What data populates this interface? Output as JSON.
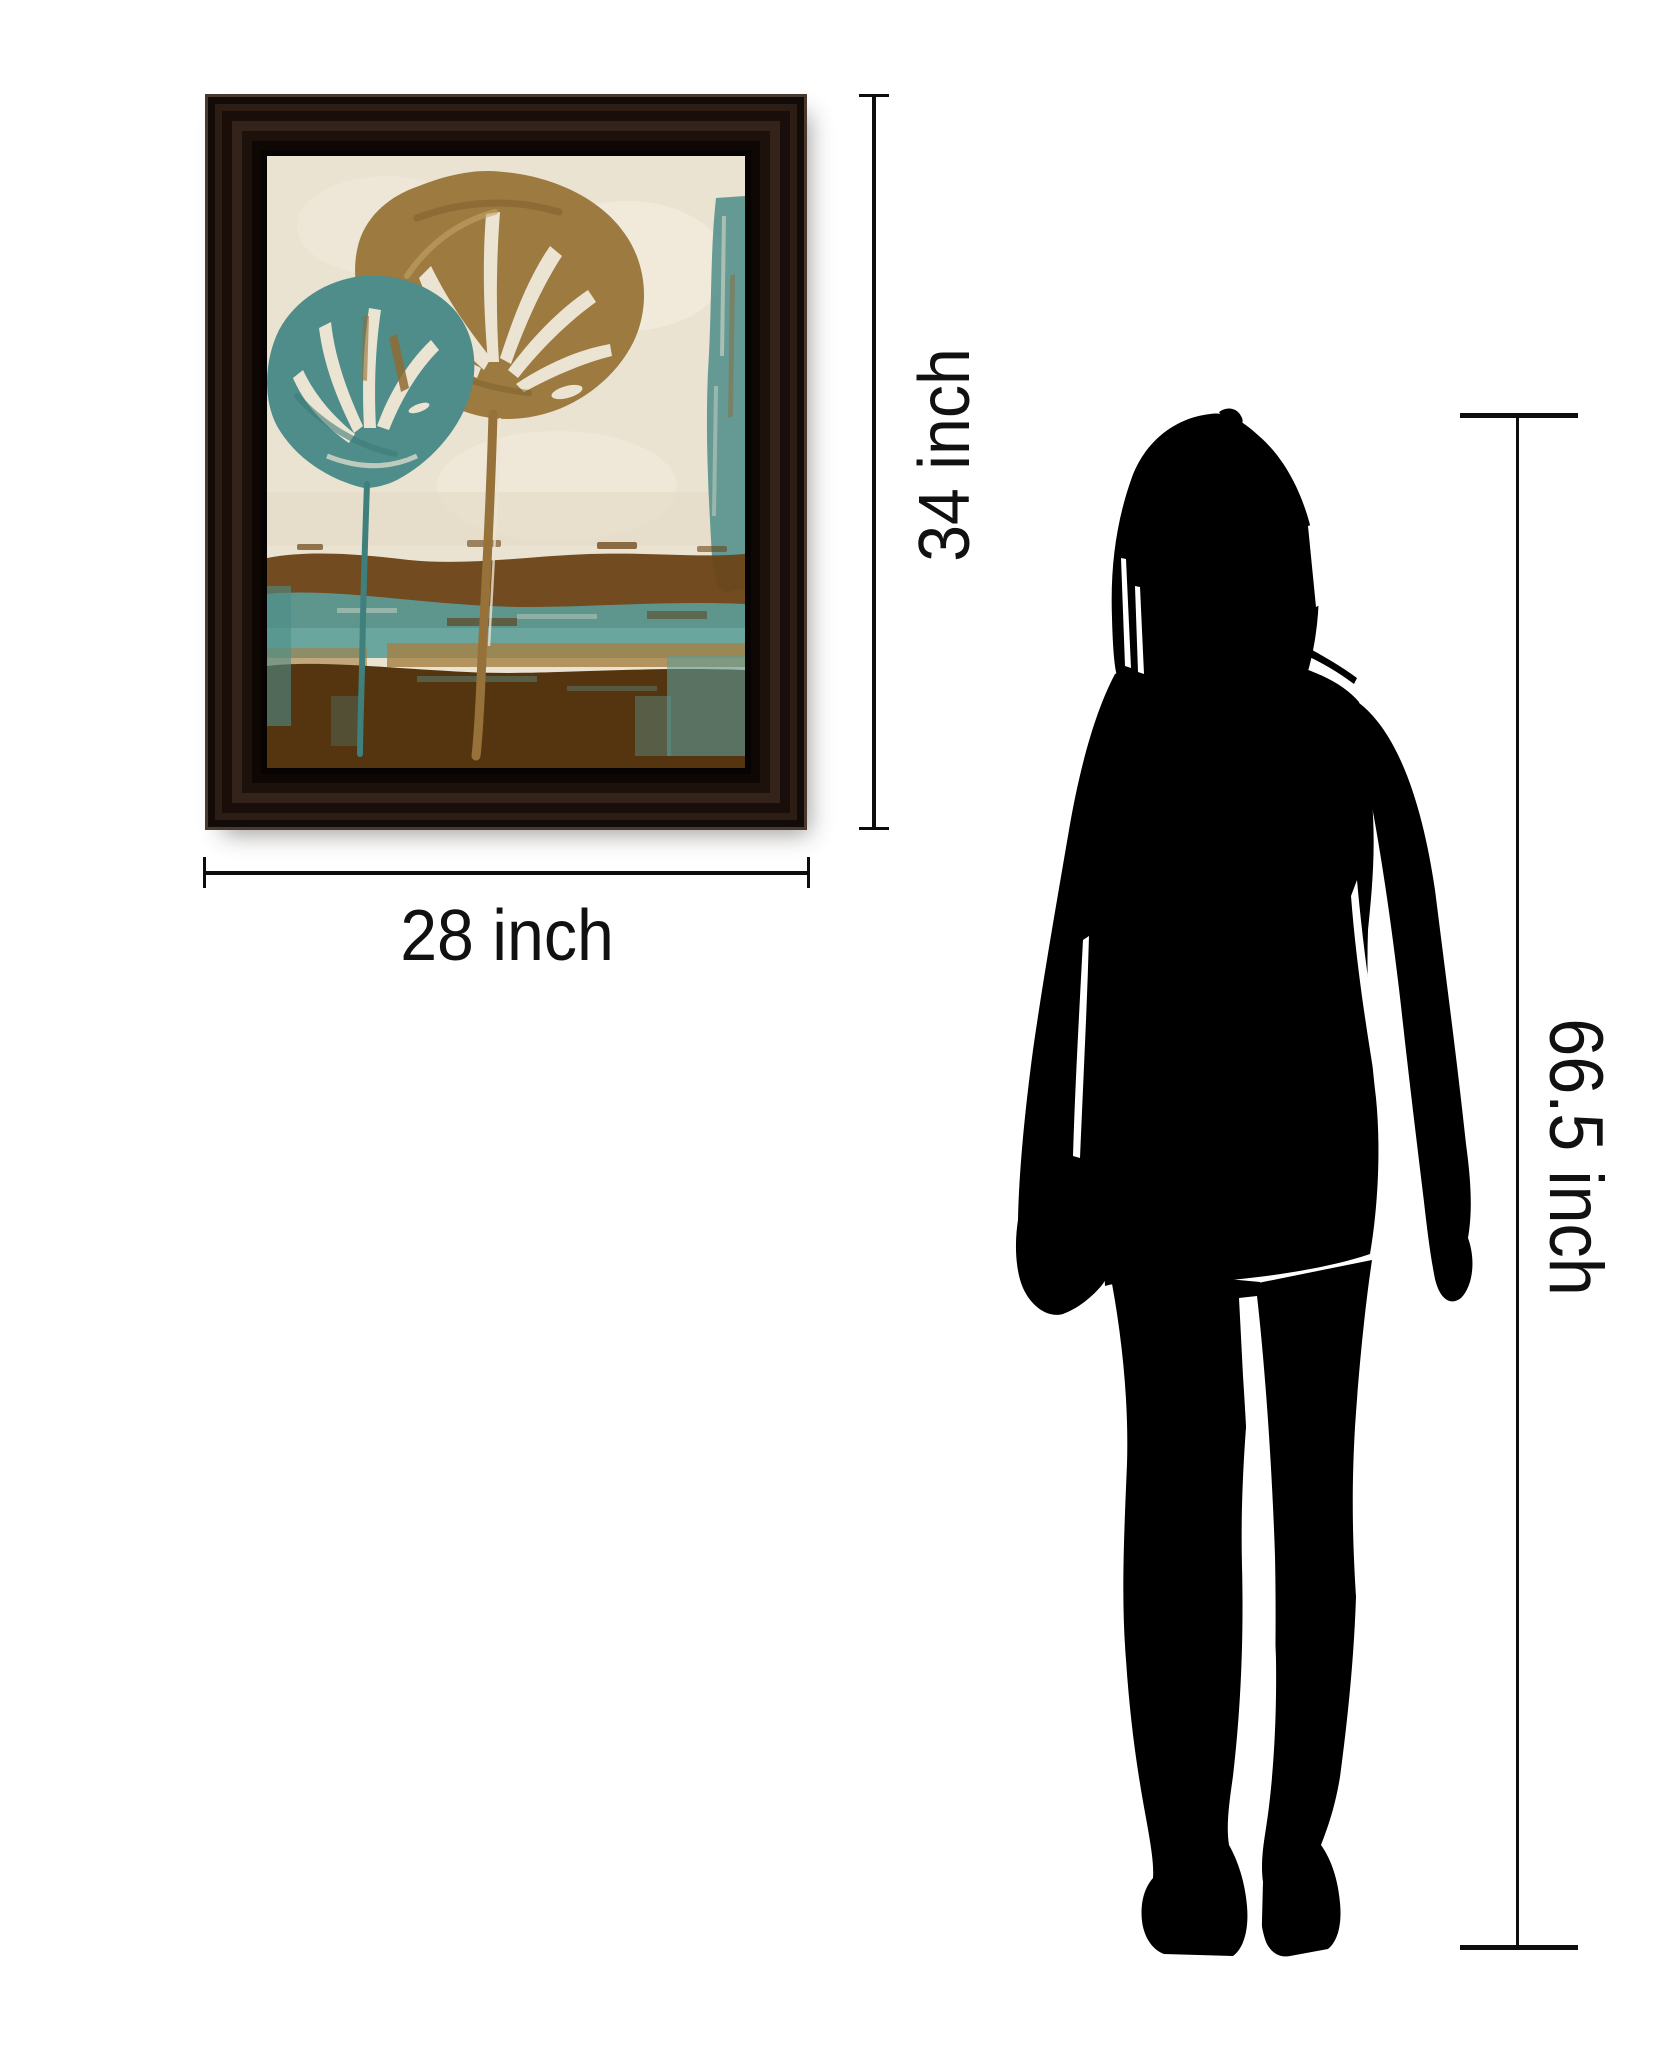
{
  "scene": {
    "background": "#ffffff"
  },
  "dimensions": {
    "frame_height_label": "34 inch",
    "frame_width_label": "28 inch",
    "person_height_label": "66.5 inch"
  },
  "dimension_lines": {
    "color": "#0d0d0d",
    "label_color": "#111111"
  },
  "framed_art": {
    "frame_color": "#1c110b",
    "art_palette": {
      "background": "#ebe3d2",
      "background_light": "#f4edde",
      "leaf_gold": "#9d7a3f",
      "leaf_gold_dark": "#7d5f2e",
      "leaf_gold_highlight": "#c3a368",
      "leaf_teal": "#4e8d89",
      "leaf_teal_dark": "#3e7b78",
      "band_brown": "#6b4316",
      "band_teal": "#5c9d98",
      "bottom_brown": "#553410",
      "tan_streak": "#a57f42",
      "slit_cream": "#ece4d3"
    }
  },
  "person": {
    "silhouette_color": "#000000"
  }
}
